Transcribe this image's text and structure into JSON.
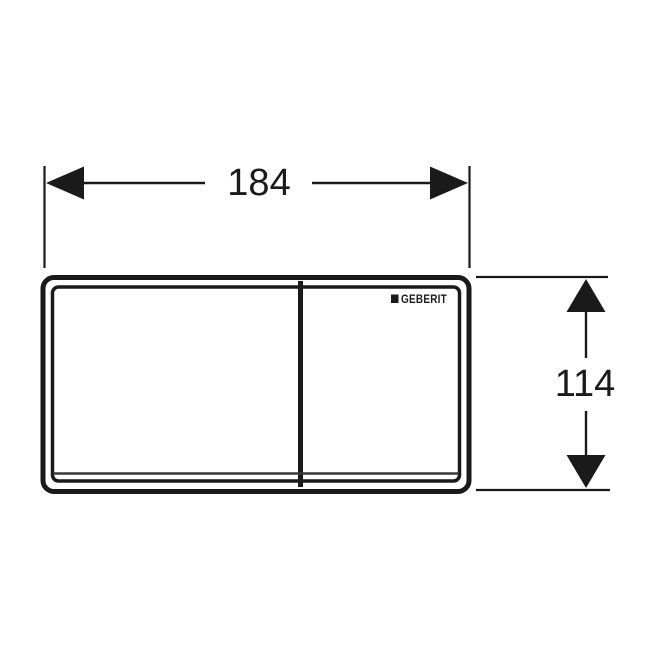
{
  "drawing": {
    "type": "technical-dimension-drawing",
    "subject": "flush-plate-front-view",
    "brand_logo": {
      "text": "GEBERIT",
      "icon": "filled-square"
    },
    "dimensions": {
      "width": {
        "label": "184"
      },
      "height": {
        "label": "114"
      }
    },
    "colors": {
      "line": "#1a1a1a",
      "background": "#ffffff"
    }
  }
}
